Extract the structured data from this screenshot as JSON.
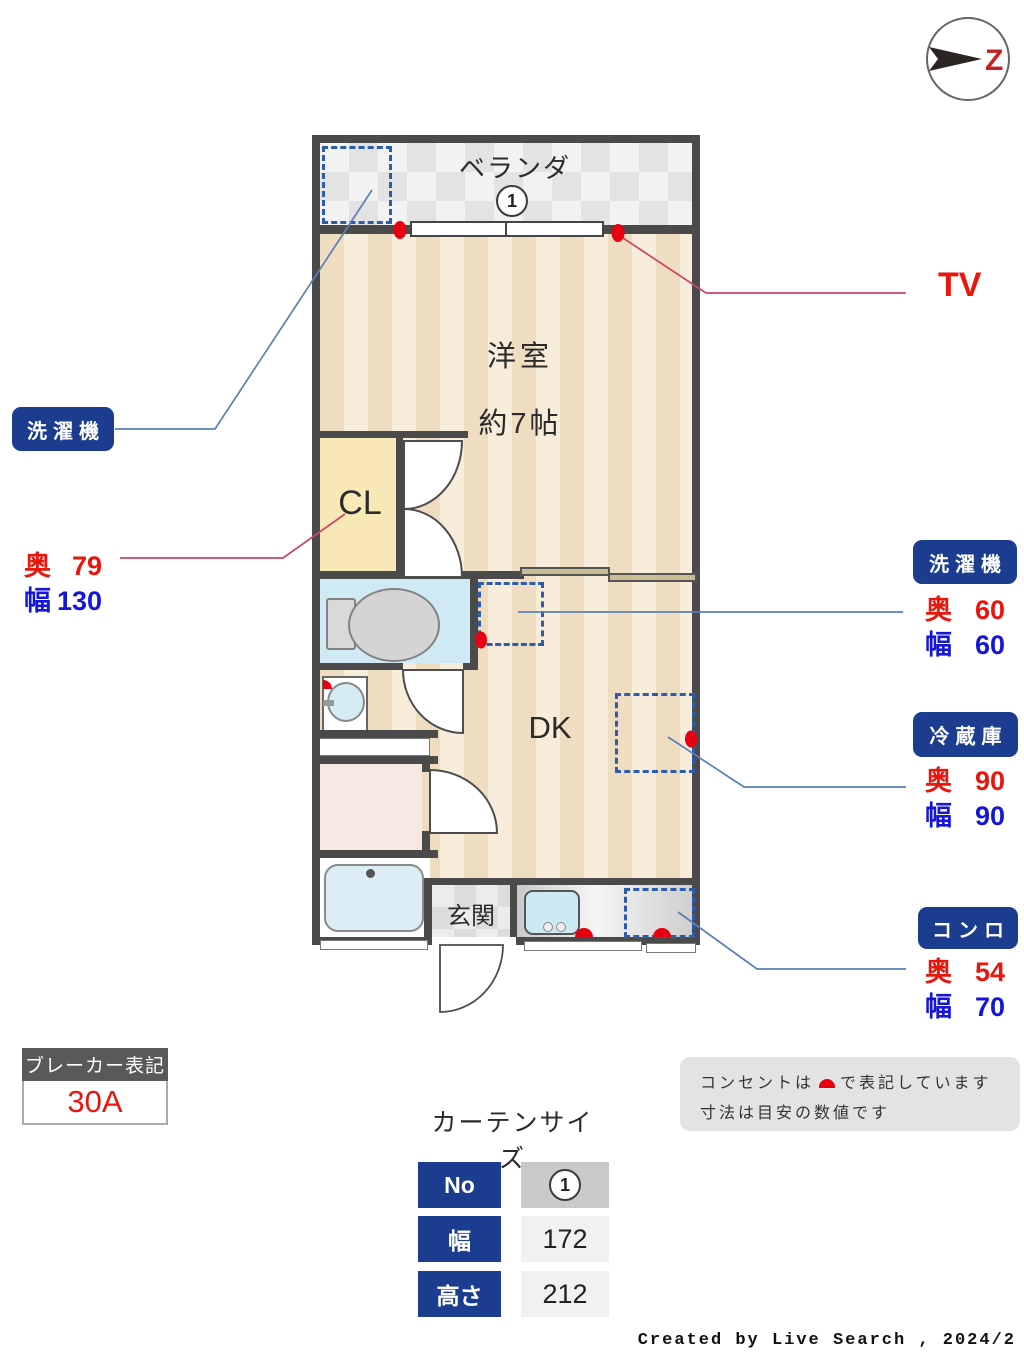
{
  "compass": {
    "north_letter": "Z"
  },
  "plan": {
    "balcony": {
      "label": "ベランダ",
      "number": "1"
    },
    "room": {
      "label": "洋室",
      "size": "約7帖"
    },
    "closet": {
      "label": "CL"
    },
    "dk": {
      "label": "DK"
    },
    "entrance": {
      "label": "玄関"
    }
  },
  "callouts": {
    "washer_balcony": {
      "title": "洗濯機"
    },
    "closet_dims": {
      "depth_label": "奥",
      "depth": "79",
      "width_label": "幅",
      "width": "130"
    },
    "tv": {
      "label": "TV"
    },
    "washer_indoor": {
      "title": "洗濯機",
      "depth_label": "奥",
      "depth": "60",
      "width_label": "幅",
      "width": "60"
    },
    "fridge": {
      "title": "冷蔵庫",
      "depth_label": "奥",
      "depth": "90",
      "width_label": "幅",
      "width": "90"
    },
    "stove": {
      "title": "コンロ",
      "depth_label": "奥",
      "depth": "54",
      "width_label": "幅",
      "width": "70"
    }
  },
  "breaker": {
    "title": "ブレーカー表記",
    "value": "30A"
  },
  "curtain": {
    "title": "カーテンサイズ",
    "no_label": "No",
    "no_value": "1",
    "width_label": "幅",
    "width_value": "172",
    "height_label": "高さ",
    "height_value": "212"
  },
  "notes": {
    "line1_pre": "コンセントは",
    "line1_post": "で表記しています",
    "line2": "寸法は目安の数値です"
  },
  "footer": {
    "credit": "Created by Live Search , 2024/2"
  },
  "colors": {
    "accent_navy": "#1c3d8f",
    "outlet_red": "#e60012",
    "dim_red": "#e8160c",
    "dim_blue": "#1616d8"
  }
}
